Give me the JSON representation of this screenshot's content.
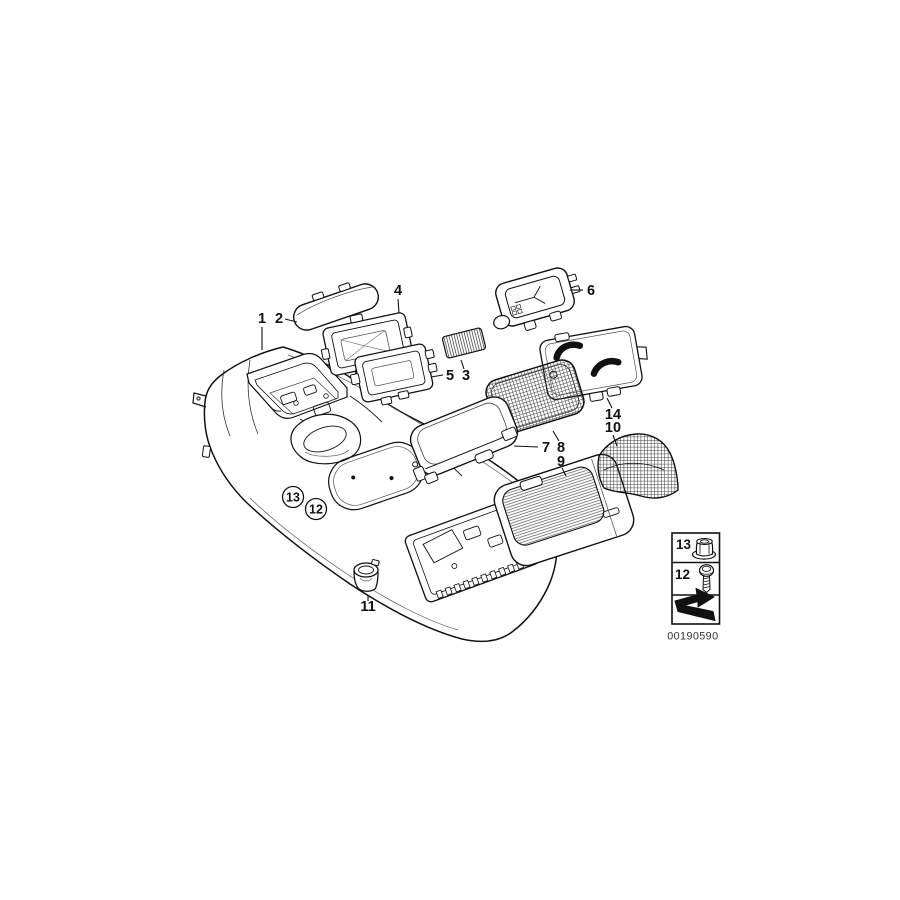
{
  "diagram": {
    "description": "Exploded parts diagram of a car centre console",
    "background": "#ffffff",
    "line_color": "#111111",
    "image_number": "00190590",
    "callouts": {
      "p1": "1",
      "p2": "2",
      "p3": "3",
      "p4": "4",
      "p5": "5",
      "p6": "6",
      "p7": "7",
      "p8": "8",
      "p9": "9",
      "p10": "10",
      "p11": "11",
      "p14": "14"
    },
    "circled_callouts": {
      "c13": "13",
      "c12": "12"
    },
    "legend": {
      "rows": [
        {
          "label": "13",
          "icon": "flange-nut-icon"
        },
        {
          "label": "12",
          "icon": "screw-icon"
        },
        {
          "label": "",
          "icon": "direction-arrow-icon"
        }
      ]
    }
  }
}
